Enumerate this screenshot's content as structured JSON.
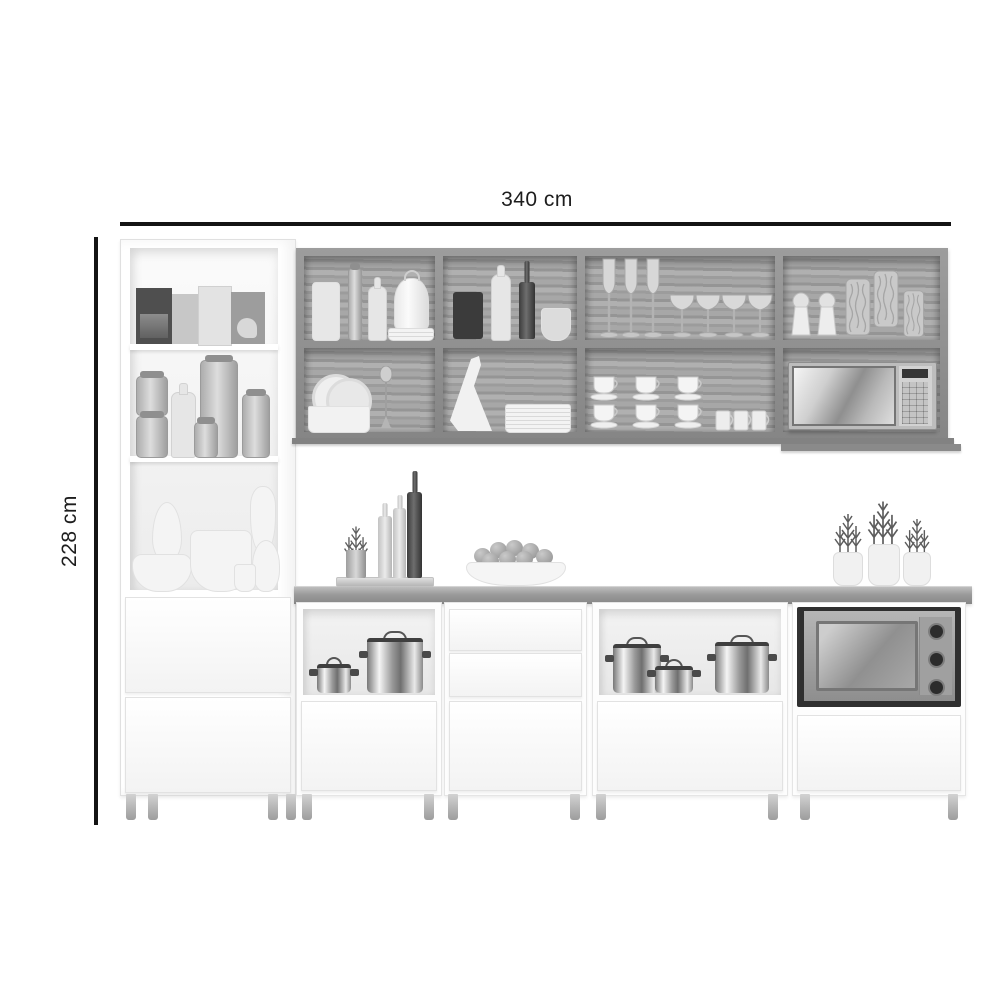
{
  "diagram": {
    "title": "kitchen-cabinet-set-dimension-diagram",
    "width_label": "340 cm",
    "height_label": "228 cm"
  },
  "colors": {
    "background": "#ffffff",
    "dimension_line": "#141414",
    "dimension_text": "#1d1d1d",
    "cabinet_body": "#ffffff",
    "wood_interior": "#a4a4a4",
    "wood_frame": "#8f8f8f",
    "countertop": "#9a9a9a",
    "appliance_steel": "#bdbdbd",
    "oven_frame": "#2f2f2f",
    "pot_steel": "#c9c9c9"
  },
  "furniture": {
    "name": "modular-kitchen-set",
    "sections": [
      "tall-pantry-cabinet",
      "upper-wall-cabinet-8-open-cubbies",
      "base-cabinet-open-niche-and-door",
      "base-cabinet-two-drawers-and-door",
      "base-cabinet-open-niche-and-drawer",
      "base-cabinet-built-in-oven-and-drawer"
    ],
    "pantry_items": [
      "cereal-boxes",
      "storage-jars",
      "milk-bottle",
      "ceramic-bowls",
      "vases"
    ],
    "wall_cabinet_items": [
      "canister",
      "glass-bottle",
      "milk-bottle",
      "cheese-dome",
      "plate-stack",
      "black-canister",
      "white-bottle",
      "olive-oil-bottle",
      "mortar-and-pestle",
      "champagne-flutes",
      "brandy-glasses",
      "salt-pepper-shakers",
      "textured-glass-jars",
      "dish-rack",
      "whisk",
      "pitcher",
      "plates",
      "stacked-cups",
      "mugs",
      "microwave"
    ],
    "counter_items": [
      "serving-tray",
      "herb-sprigs",
      "oil-bottles",
      "wine-bottle",
      "fruit-bowl",
      "potted-herb-plants"
    ],
    "base_items": [
      "stock-pots",
      "saucepans",
      "built-in-oven"
    ]
  }
}
